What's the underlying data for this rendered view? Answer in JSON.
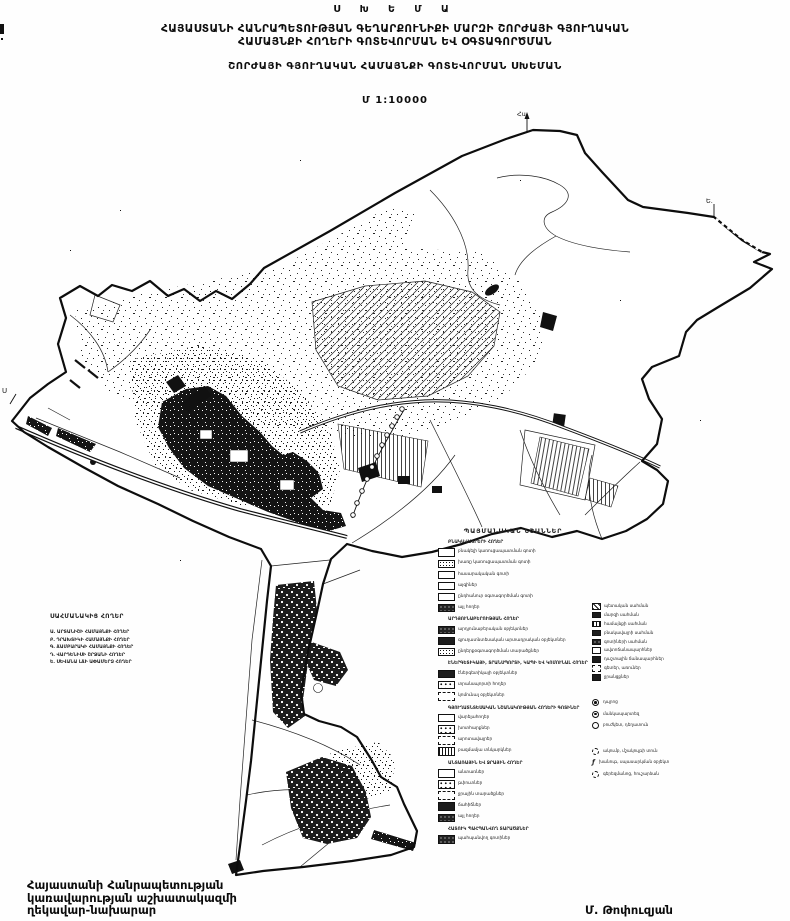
{
  "header": {
    "schema_label": "Ս Խ Ե Մ Ա",
    "title_line1": "ՀԱՅԱՍՏԱՆԻ ՀԱՆՐԱՊԵՏՈՒԹՅԱՆ ԳԵՂԱՐՔՈՒՆԻՔԻ ՄԱՐԶԻ ՇՈՐԺԱՅԻ ԳՅՈՒՂԱԿԱՆ",
    "title_line2": "ՀԱՄԱՅՆՔԻ ՀՈՂԵՐԻ ԳՈՏԵՎՈՐՄԱՆ ԵՎ ՕԳՏԱԳՈՐԾՄԱՆ",
    "subtitle": "ՇՈՐԺԱՅԻ ԳՅՈՒՂԱԿԱՆ ՀԱՄԱՅՆՔԻ ԳՈՏԵՎՈՐՄԱՆ ՍԽԵՄԱՆ",
    "scale": "Մ 1:10000"
  },
  "map": {
    "north_arrow_label": "Հս",
    "west_point_label": "Ս",
    "east_point_label": "Ե."
  },
  "adjacent_lands": {
    "title": "ՍԱՀՄԱՆԱԿԻՑ ՀՈՂԵՐ",
    "lines": [
      "Ա․ ԱՐՏԱՆԻՇԻ ՀԱՄԱՅՆՔԻ ՀՈՂԵՐ",
      "Բ․ ԴՐԱԽՏԻԿԻ ՀԱՄԱՅՆՔԻ ՀՈՂԵՐ",
      "Գ․ ՃԱՄԲԱՐԱԿԻ ՀԱՄԱՅՆՔԻ ՀՈՂԵՐ",
      "Դ․ ՎԱՐԴԵՆԻՍԻ ՇՐՋԱՆԻ ՀՈՂԵՐ",
      "Ե․ ՍԵՎԱՆԱ ԼՃԻ ԱՓԱՄԵՐՁ ՀՈՂԵՐ"
    ]
  },
  "legend": {
    "title": "ՊԱՅՄԱՆԱԿԱՆ ՆՇԱՆՆԵՐ",
    "groups": [
      {
        "heading": "ԲՆԱԿԱՎԱՅՐԵՐԻ ՀՈՂԵՐ",
        "items": [
          {
            "label": "բնակելի կառուցապատման գոտի"
          },
          {
            "label": "խառը կառուցապատման գոտի"
          },
          {
            "label": "հասարակական գոտի"
          },
          {
            "label": "այգիներ"
          },
          {
            "label": "ընդհանուր օգտագործման գոտի"
          },
          {
            "label": "այլ հողեր"
          }
        ]
      },
      {
        "heading": "ԱՐԴՅՈՒՆԱԲԵՐՈՒԹՅԱՆ ՀՈՂԵՐ",
        "items": [
          {
            "label": "արդյունաբերական օբյեկտներ"
          },
          {
            "label": "գյուղատնտեսական արտադրական օբյեկտներ"
          },
          {
            "label": "ընդերքօգտագործման տարածքներ"
          }
        ]
      },
      {
        "heading": "ԷՆԵՐԳԵՏԻԿԱՅԻ, ՏՐԱՆՍՊՈՐՏԻ, ԿԱՊԻ ԵՎ ԿՈՄՈՒՆԱԼ ՀՈՂԵՐ",
        "items": [
          {
            "label": "էներգետիկայի օբյեկտներ"
          },
          {
            "label": "տրանսպորտի հողեր"
          },
          {
            "label": "կոմունալ օբյեկտներ"
          }
        ]
      },
      {
        "heading": "ԳՅՈՒՂԱՏՆՏԵՍԱԿԱՆ ՆՇԱՆԱԿՈՒԹՅԱՆ ՀՈՂԵՐԻ ԳՈՏԻՆԵՐ",
        "items": [
          {
            "label": "վարելահողեր"
          },
          {
            "label": "խոտհարքներ"
          },
          {
            "label": "արոտավայրեր"
          },
          {
            "label": "բազմամյա տնկարկներ"
          }
        ]
      },
      {
        "heading": "ԱՆՏԱՌԱՅԻՆ ԵՎ ՋՐԱՅԻՆ ՀՈՂԵՐ",
        "items": [
          {
            "label": "անտառներ"
          },
          {
            "label": "թփուտներ"
          },
          {
            "label": "ջրային տարածքներ"
          },
          {
            "label": "ճահիճներ"
          },
          {
            "label": "այլ հողեր"
          }
        ]
      },
      {
        "heading": "ՀԱՏՈՒԿ ՊԱՀՊԱՆՎՈՂ ՏԱՐԱԾՔՆԵՐ",
        "items": [
          {
            "label": "պահպանվող գոտիներ"
          }
        ]
      }
    ],
    "right_column": {
      "items": [
        {
          "label": "պետական սահման"
        },
        {
          "label": "մարզի սահման"
        },
        {
          "label": "համայնքի սահման"
        },
        {
          "label": "բնակավայրի սահման"
        },
        {
          "label": "գոտիների սահման"
        },
        {
          "label": "ավտոճանապարհներ"
        },
        {
          "label": "դաշտային ճանապարհներ"
        },
        {
          "label": "գետեր, առուներ"
        },
        {
          "label": "ջրանցքներ"
        }
      ],
      "symbols": [
        {
          "label": "դպրոց"
        },
        {
          "label": "մանկապարտեզ"
        },
        {
          "label": "բուժկետ, դեղատուն"
        },
        {
          "label": "ակումբ, մշակույթի տուն"
        },
        {
          "label": "խանութ, սպասարկման օբյեկտ"
        },
        {
          "label": "գերեզմանոց, հուշարձան"
        }
      ]
    }
  },
  "footer": {
    "left_line1": "Հայաստանի Հանրապետության",
    "left_line2": "կառավարության աշխատակազմի",
    "left_line3": "ղեկավար-նախարար",
    "signature": "Մ. Թոփուզյան"
  }
}
